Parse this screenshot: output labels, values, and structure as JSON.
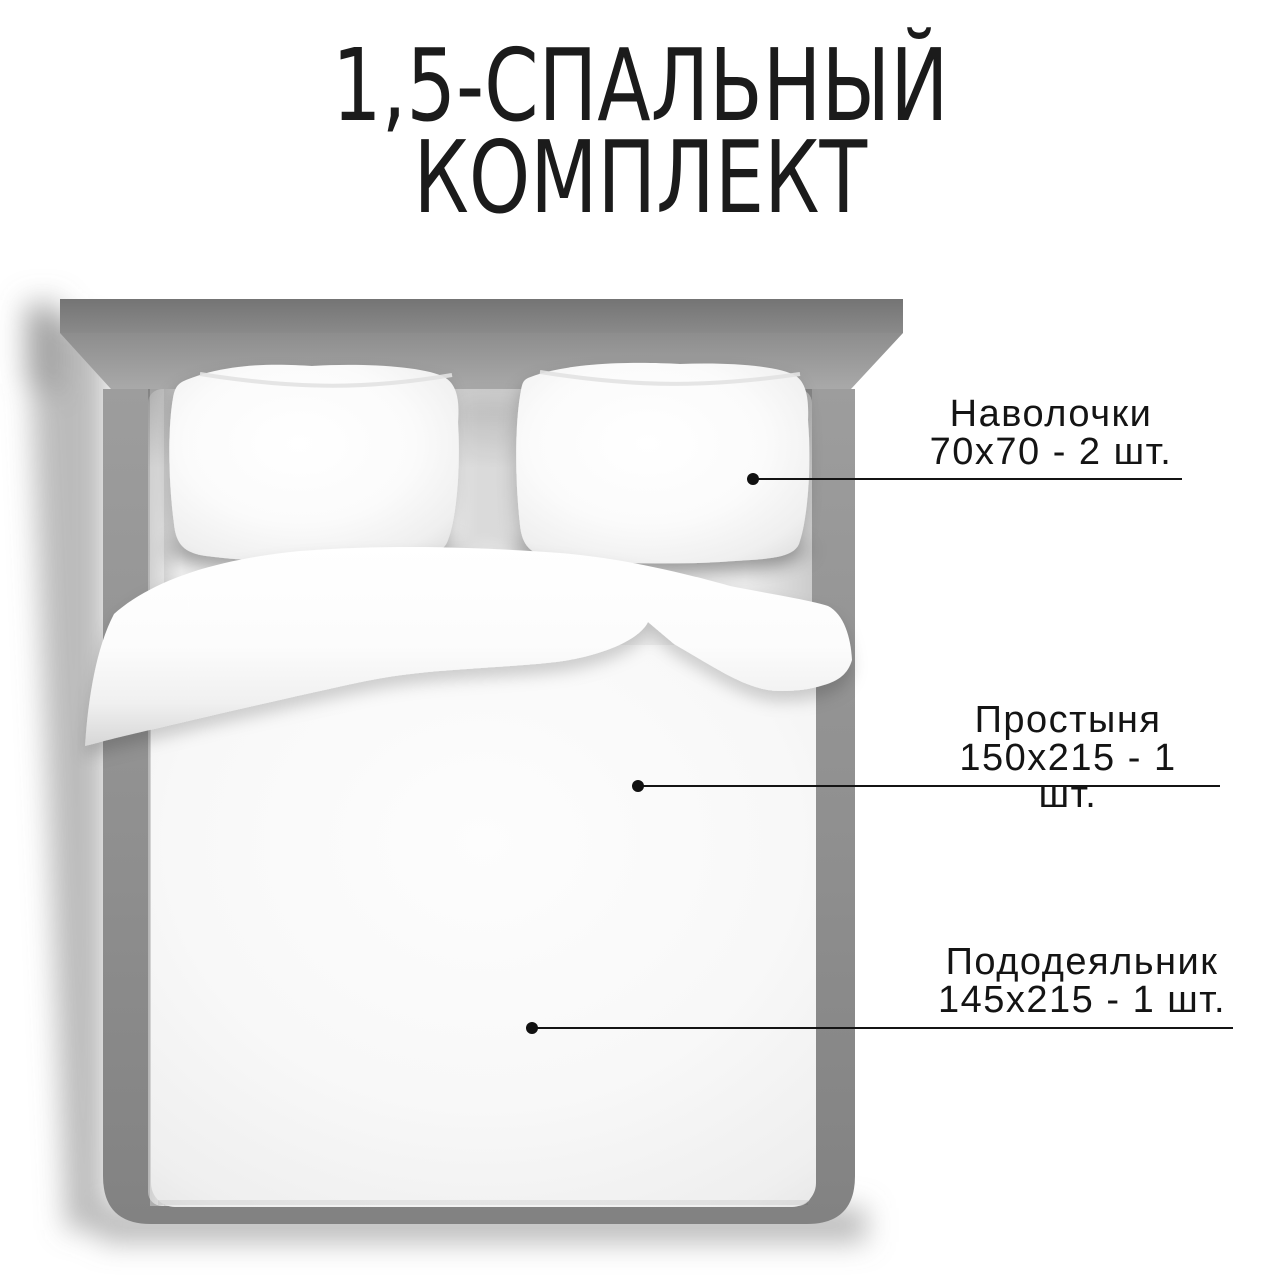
{
  "title": {
    "line1": "1,5-СПАЛЬНЫЙ",
    "line2": "КОМПЛЕКТ"
  },
  "callouts": [
    {
      "name": "Наволочки",
      "size": "70х70 - 2 шт."
    },
    {
      "name": "Простыня",
      "size": "150х215 - 1 шт."
    },
    {
      "name": "Пододеяльник",
      "size": "145х215 - 1 шт."
    }
  ],
  "illustration": {
    "subject": "bed-top-view-icon",
    "parts": [
      "headboard",
      "bed-frame",
      "pillow-left",
      "pillow-right",
      "folded-sheet",
      "duvet"
    ]
  },
  "colors": {
    "background": "#ffffff",
    "text": "#1b1b1b",
    "leader_line": "#141414",
    "headboard_gray": "#7f7f7f",
    "frame_gray": "#8f8f8f",
    "linen_white": "#f7f7f7"
  }
}
